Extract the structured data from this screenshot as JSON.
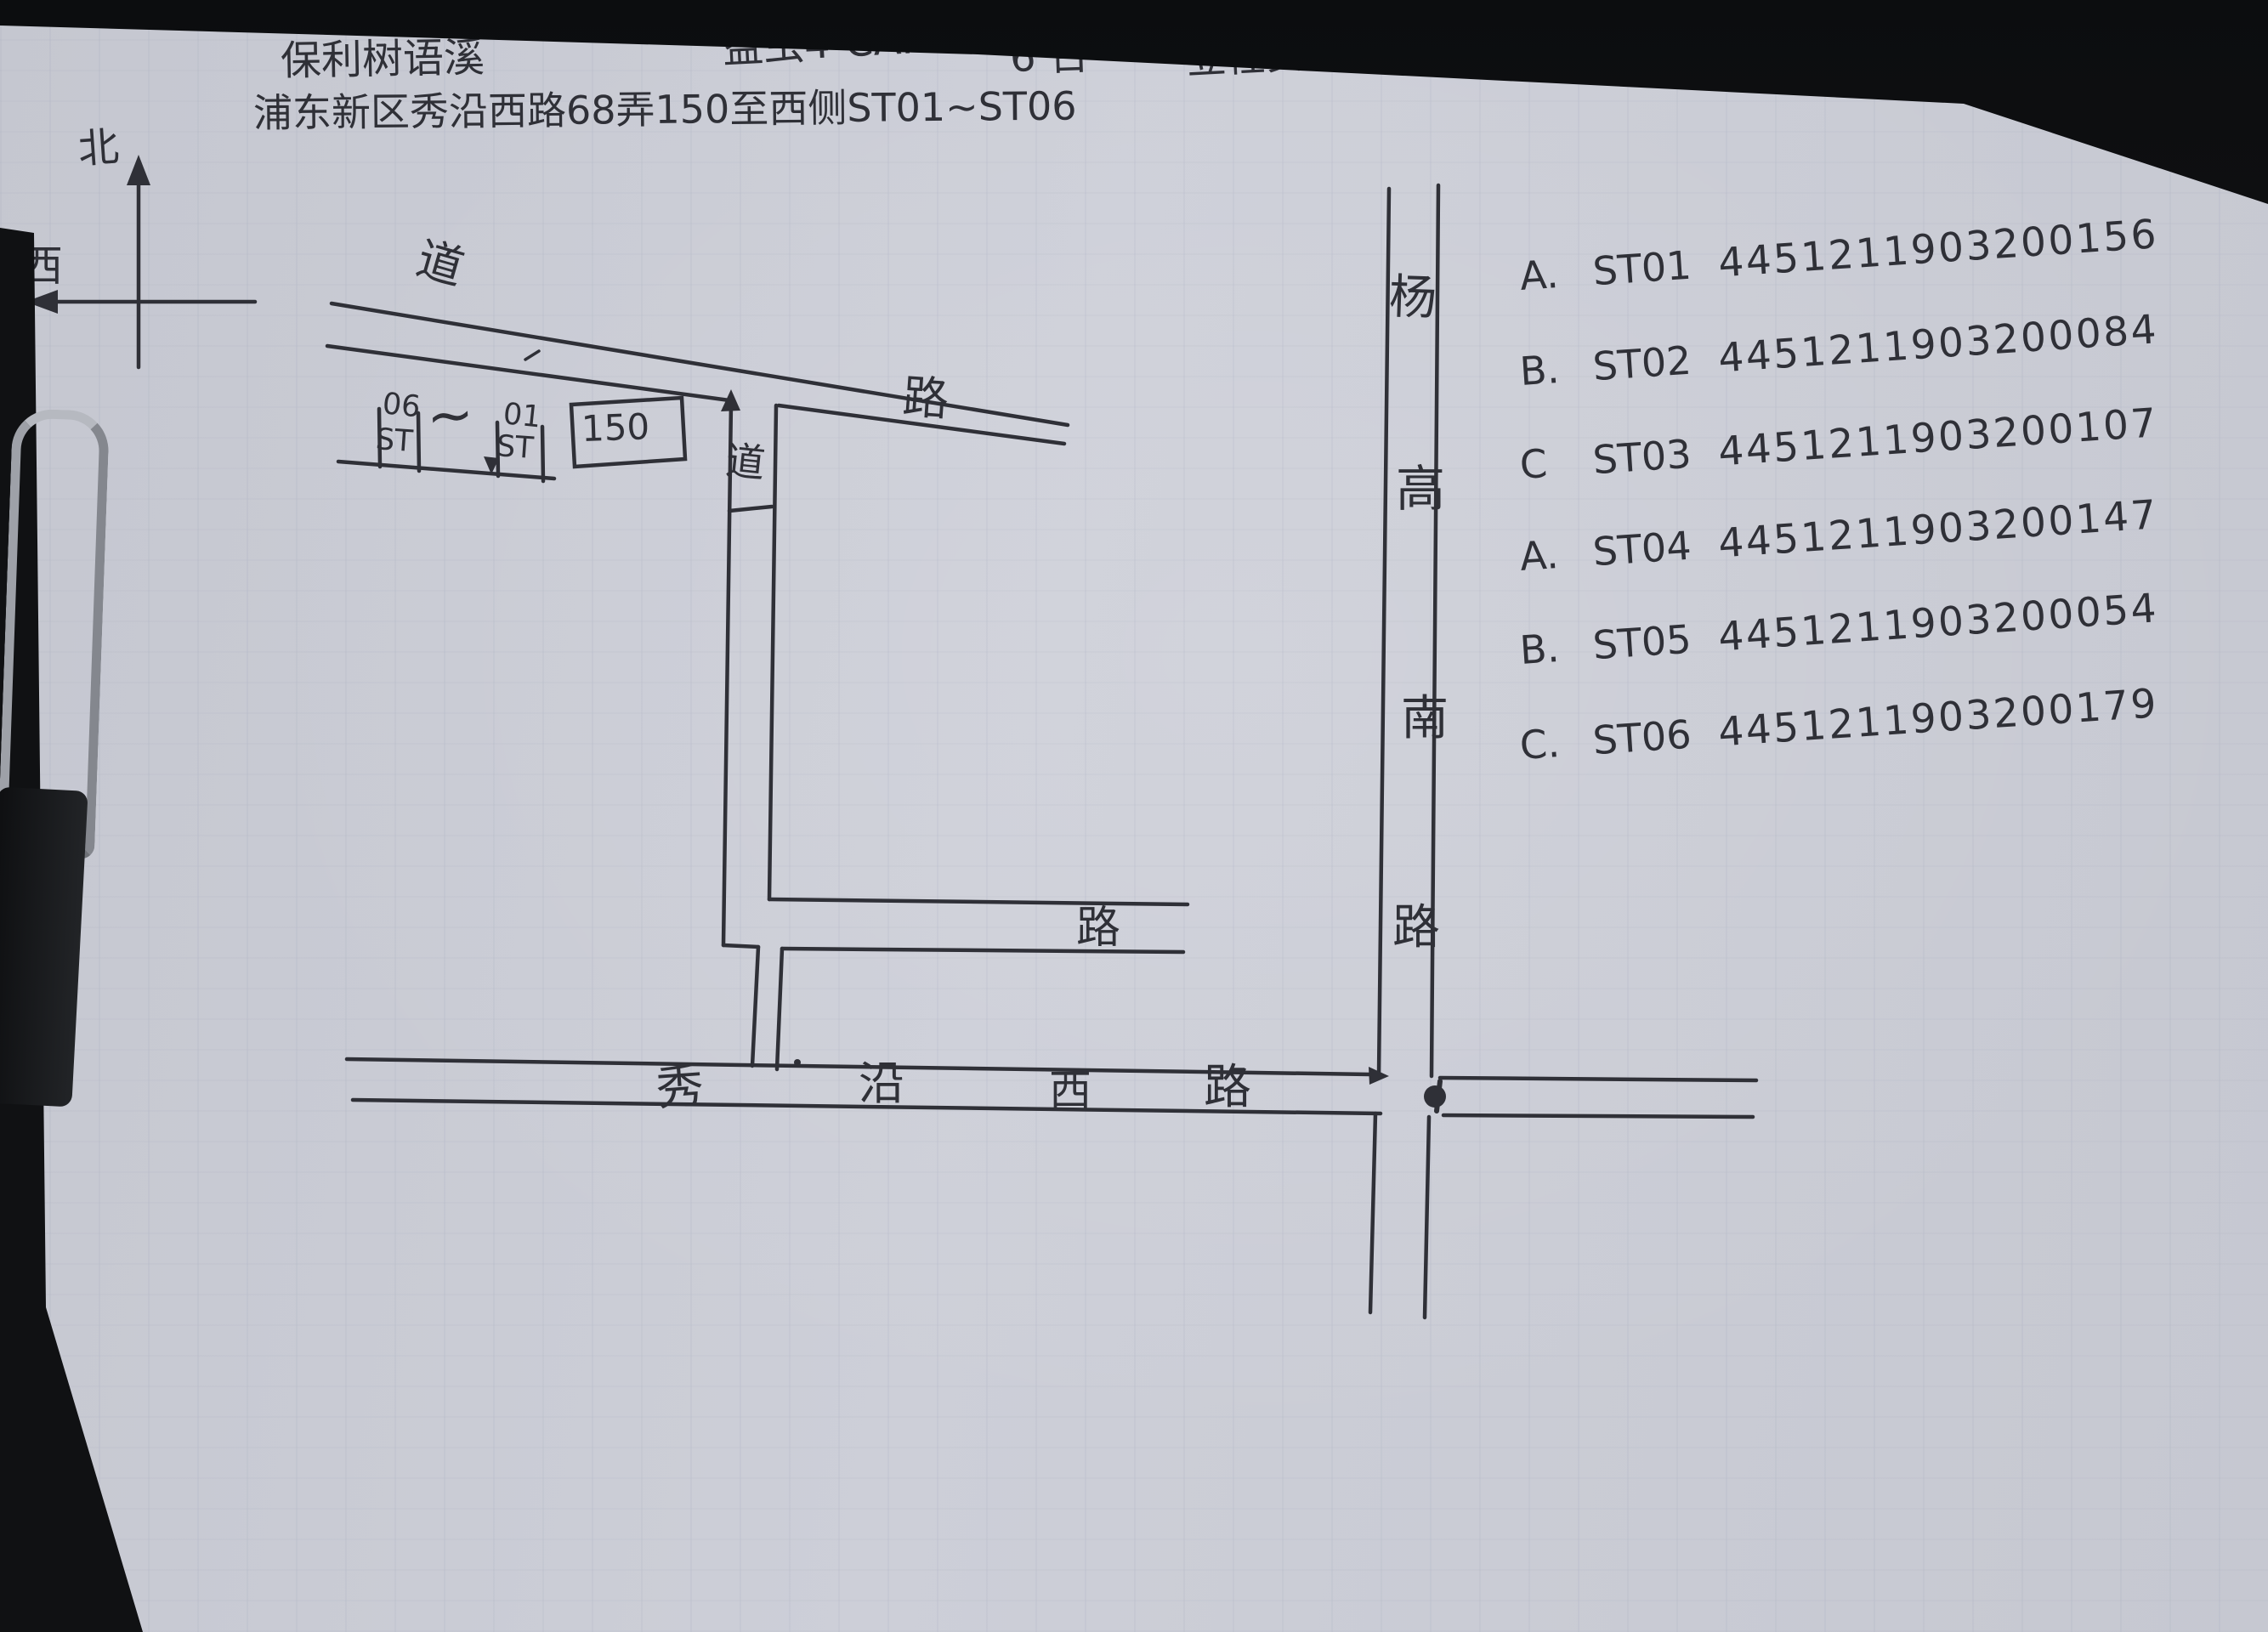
{
  "colors": {
    "paper": "#c9cbd4",
    "ink": "#2f3037",
    "background": "#121316",
    "clip_metal": "#a9acb3"
  },
  "header": {
    "project": "保利树语溪",
    "model": "益虫4-CAN",
    "quantity": "6 台",
    "task": "立柱安装",
    "card_label": "测微卡：",
    "card_number": "STZD 002493",
    "location": "浦东新区秀沿西路68弄150至西侧ST01~ST06"
  },
  "compass": {
    "north": "北",
    "west": "西"
  },
  "map": {
    "north_road": {
      "label_left": "道",
      "label_right": "路"
    },
    "lane_label": "道",
    "middle_road_label": "路",
    "building_number": "150",
    "pole_range": {
      "left_top": "06",
      "left_bottom": "ST",
      "separator": "~",
      "right_top": "01",
      "right_bottom": "ST"
    },
    "south_road": {
      "name": "秀沿西路",
      "chars": [
        "秀",
        "沿",
        "西",
        "路"
      ]
    },
    "vertical_road": {
      "name": "杨高南路",
      "chars": [
        "杨",
        "高",
        "南",
        "路"
      ]
    }
  },
  "station_list": {
    "rows": [
      {
        "letter": "A.",
        "station": "ST01",
        "number": "4451211903200156"
      },
      {
        "letter": "B.",
        "station": "ST02",
        "number": "4451211903200084"
      },
      {
        "letter": "C",
        "station": "ST03",
        "number": "4451211903200107"
      },
      {
        "letter": "A.",
        "station": "ST04",
        "number": "4451211903200147"
      },
      {
        "letter": "B.",
        "station": "ST05",
        "number": "4451211903200054"
      },
      {
        "letter": "C.",
        "station": "ST06",
        "number": "4451211903200179"
      }
    ]
  }
}
